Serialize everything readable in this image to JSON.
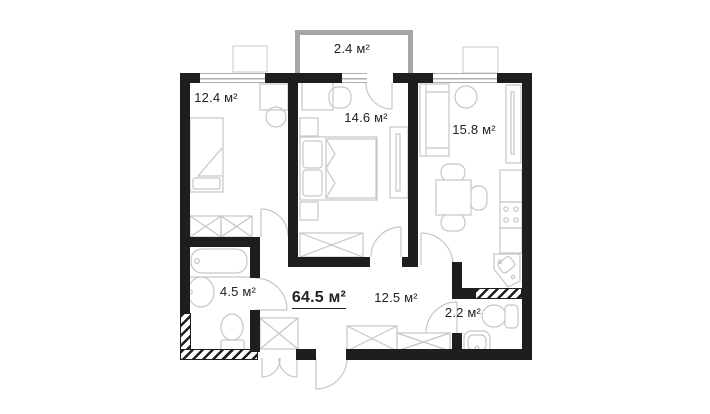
{
  "plan": {
    "type": "apartment-floor-plan",
    "total_area": {
      "label": "64.5 м²"
    },
    "rooms": [
      {
        "id": "balcony",
        "area": "2.4 м²"
      },
      {
        "id": "bedroom-1",
        "area": "12.4 м²"
      },
      {
        "id": "bedroom-2",
        "area": "14.6 м²"
      },
      {
        "id": "kitchen-living",
        "area": "15.8 м²"
      },
      {
        "id": "bathroom",
        "area": "4.5 м²"
      },
      {
        "id": "hallway",
        "area": "12.5 м²"
      },
      {
        "id": "wc",
        "area": "2.2 м²"
      }
    ],
    "colors": {
      "wall": "#1e1e1e",
      "balcony_wall": "#a5a5a5",
      "furniture_line": "#c6c6c6",
      "text": "#222222",
      "background": "#ffffff"
    }
  }
}
